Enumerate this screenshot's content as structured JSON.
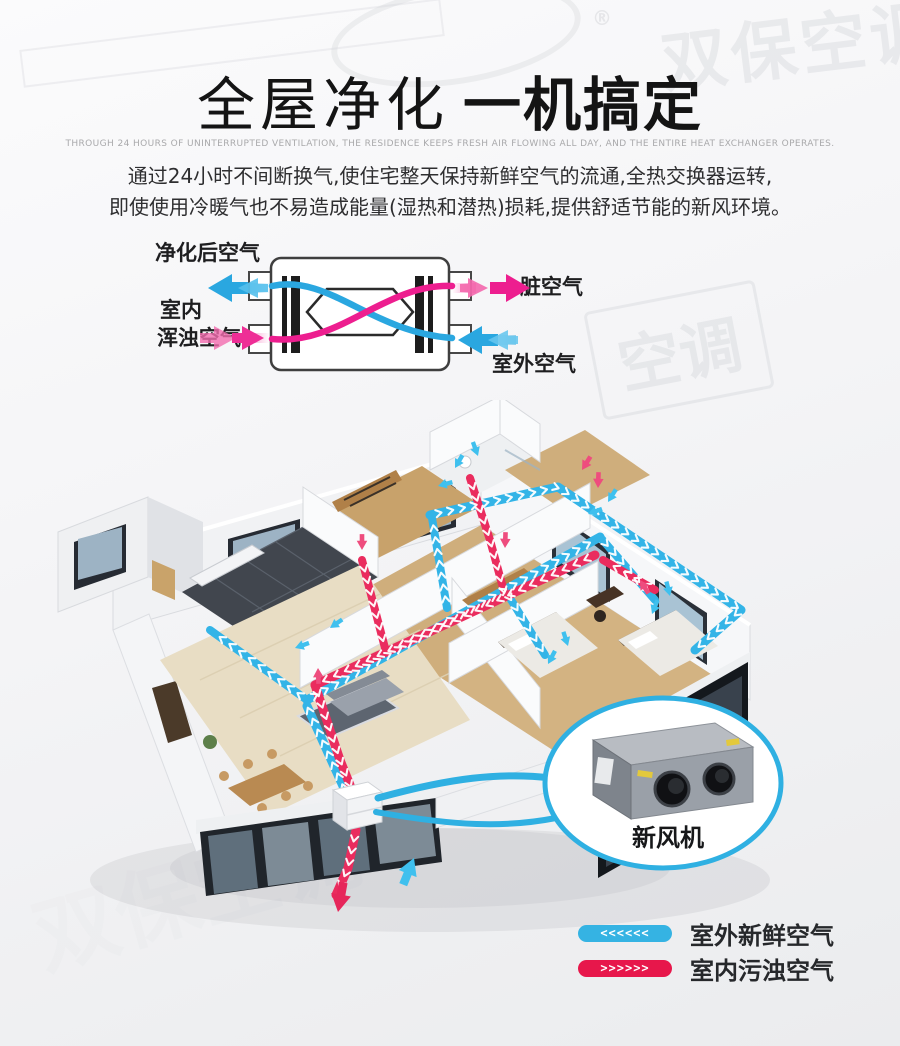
{
  "watermark": {
    "brand": "双保空调",
    "brand_short": "空调",
    "registered": "®"
  },
  "header": {
    "title_light": "全屋净化",
    "title_bold": "一机搞定",
    "subtitle_en": "THROUGH 24 HOURS OF UNINTERRUPTED VENTILATION, THE RESIDENCE KEEPS FRESH AIR FLOWING ALL DAY, AND THE ENTIRE HEAT EXCHANGER OPERATES.",
    "desc_line1": "通过24小时不间断换气,使住宅整天保持新鲜空气的流通,全热交换器运转,",
    "desc_line2": "即使使用冷暖气也不易造成能量(湿热和潜热)损耗,提供舒适节能的新风环境。"
  },
  "exchanger": {
    "label_purified": "净化后空气",
    "label_indoor_1": "室内",
    "label_indoor_2": "浑浊空气",
    "label_dirty": "脏空气",
    "label_outdoor": "室外空气",
    "color_fresh": "#2aa7e0",
    "color_polluted": "#ed1e8f"
  },
  "house": {
    "unit_label": "新风机",
    "color_supply": "#33b4e7",
    "color_exhaust": "#ea2c5e"
  },
  "legend": {
    "items": [
      {
        "label": "室外新鲜空气",
        "color": "#35b3e3",
        "chevrons": "<<<<<<",
        "direction": "left"
      },
      {
        "label": "室内污浊空气",
        "color": "#e7174b",
        "chevrons": ">>>>>>",
        "direction": "right"
      }
    ]
  }
}
